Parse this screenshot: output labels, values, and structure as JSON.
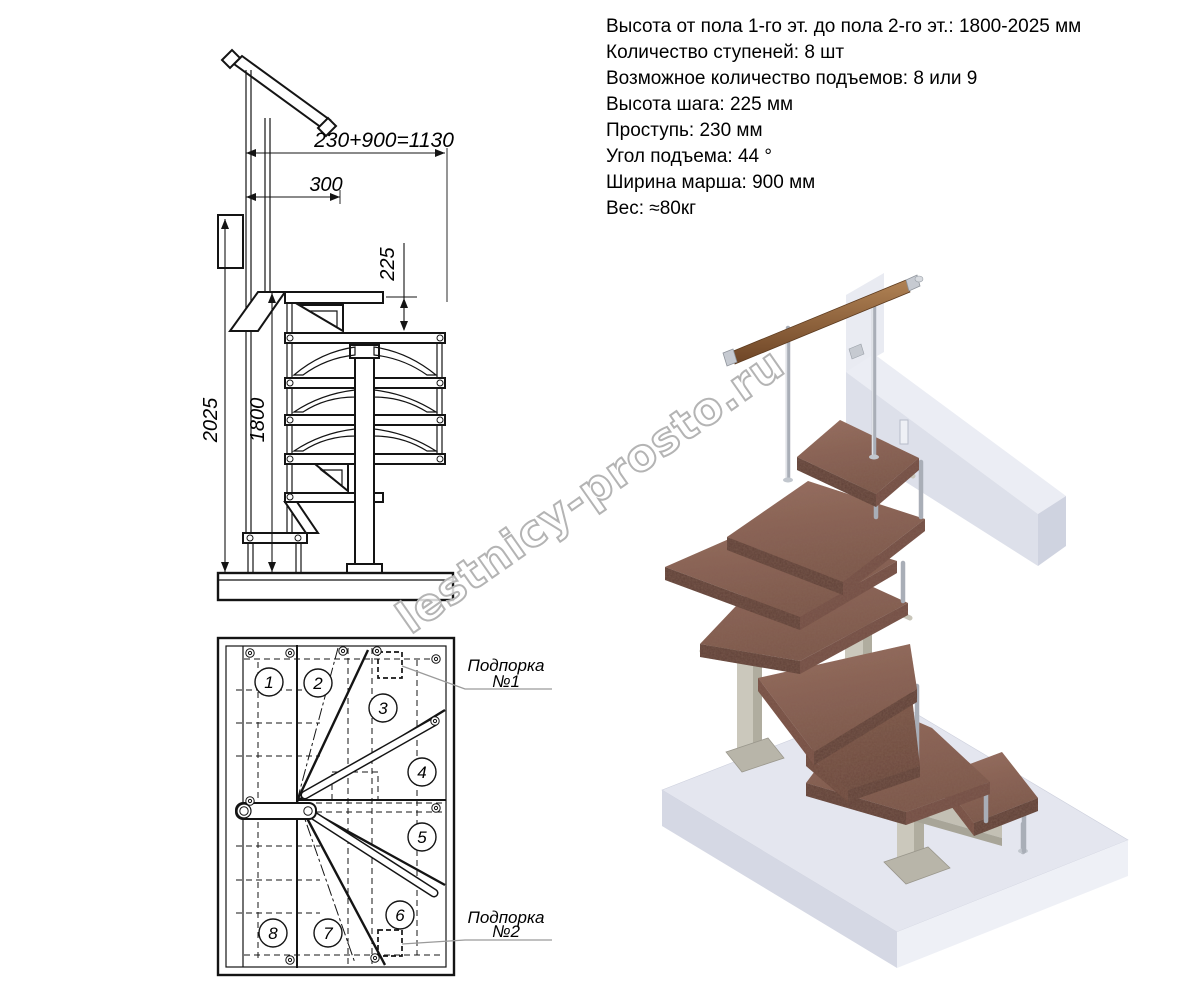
{
  "specs": {
    "lines": [
      "Высота от пола 1-го эт. до пола 2-го эт.: 1800-2025 мм",
      "Количество ступеней: 8 шт",
      "Возможное количество подъемов: 8 или 9",
      "Высота шага: 225 мм",
      "Проступь: 230 мм",
      "Угол подъема: 44 °",
      "Ширина марша: 900 мм",
      "Вес: ≈80кг"
    ]
  },
  "elevation_view": {
    "dims": {
      "total_run": "230+900=1130",
      "top_offset": "300",
      "riser": "225",
      "height_max": "2025",
      "height_min": "1800"
    }
  },
  "plan_view": {
    "steps": [
      "1",
      "2",
      "3",
      "4",
      "5",
      "6",
      "7",
      "8"
    ],
    "support_1": {
      "line1": "Подпорка",
      "line2": "№1"
    },
    "support_2": {
      "line1": "Подпорка",
      "line2": "№2"
    }
  },
  "watermark": {
    "text": "lestnicy-prosto.ru"
  },
  "colors": {
    "line": "#141414",
    "wood": "#8a6255",
    "wood_edge": "#5f4138",
    "handrail_wood": "#96683f",
    "metal_beige": "#c9c6ba",
    "chrome": "#a9aeb7",
    "floor": "#e4e6ef",
    "beam": "#dde0ea",
    "watermark_outline": "#b4b4b4"
  }
}
